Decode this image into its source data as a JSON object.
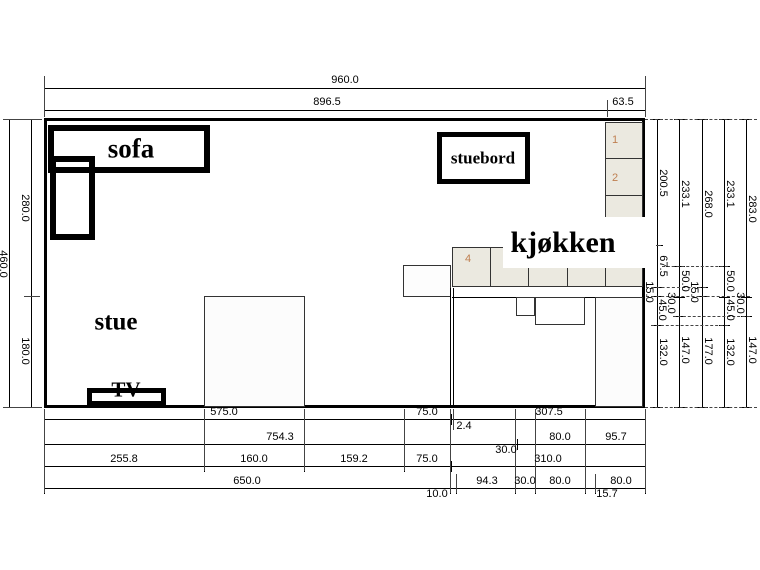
{
  "drawing": {
    "room_labels": {
      "sofa": "sofa",
      "stue": "stue",
      "stuebord": "stuebord",
      "kjokken": "kjøkken",
      "tv": "TV"
    },
    "cabinet_numbers": {
      "c1": "1",
      "c2": "2",
      "c4": "4"
    },
    "colors": {
      "background": "#ffffff",
      "line": "#000000",
      "cabinet_fill": "#ebe9e0",
      "cabinet_number": "#bf7f50"
    },
    "overall": {
      "width_label": "960.0",
      "height_label": "460.0"
    },
    "dimensions": {
      "horizontal": [
        {
          "name": "overall-width",
          "y": 88,
          "ticks": [
            44,
            645
          ],
          "labels": [
            {
              "t": "960.0",
              "cx": 345,
              "cy": 80
            }
          ]
        },
        {
          "name": "width-breakdown",
          "y": 110,
          "ticks": [
            44,
            607,
            645
          ],
          "labels": [
            {
              "t": "896.5",
              "cx": 327,
              "cy": 102
            },
            {
              "t": "63.5",
              "cx": 623,
              "cy": 102
            }
          ]
        },
        {
          "name": "bottom-row-1",
          "y": 419,
          "ticks": [
            44,
            404,
            451,
            453,
            645
          ],
          "labels": [
            {
              "t": "575.0",
              "cx": 224,
              "cy": 412
            },
            {
              "t": "75.0",
              "cx": 427,
              "cy": 412
            },
            {
              "t": "2.4",
              "cx": 464,
              "cy": 426
            },
            {
              "t": "307.5",
              "cx": 549,
              "cy": 412
            }
          ]
        },
        {
          "name": "bottom-row-2",
          "y": 444,
          "ticks": [
            44,
            517,
            535,
            585,
            645
          ],
          "labels": [
            {
              "t": "754.3",
              "cx": 280,
              "cy": 437
            },
            {
              "t": "30.0",
              "cx": 506,
              "cy": 450
            },
            {
              "t": "80.0",
              "cx": 560,
              "cy": 437
            },
            {
              "t": "95.7",
              "cx": 616,
              "cy": 437
            }
          ]
        },
        {
          "name": "bottom-row-3",
          "y": 466,
          "ticks": [
            44,
            204,
            304,
            404,
            451,
            645
          ],
          "labels": [
            {
              "t": "255.8",
              "cx": 124,
              "cy": 459
            },
            {
              "t": "160.0",
              "cx": 254,
              "cy": 459
            },
            {
              "t": "159.2",
              "cx": 354,
              "cy": 459
            },
            {
              "t": "75.0",
              "cx": 427,
              "cy": 459
            },
            {
              "t": "310.0",
              "cx": 548,
              "cy": 459
            }
          ]
        },
        {
          "name": "bottom-row-4",
          "y": 488,
          "ticks": [
            44,
            450,
            456,
            515,
            535,
            585,
            595,
            645
          ],
          "labels": [
            {
              "t": "650.0",
              "cx": 247,
              "cy": 481
            },
            {
              "t": "10.0",
              "cx": 437,
              "cy": 494
            },
            {
              "t": "94.3",
              "cx": 487,
              "cy": 481
            },
            {
              "t": "30.0",
              "cx": 525,
              "cy": 481
            },
            {
              "t": "80.0",
              "cx": 560,
              "cy": 481
            },
            {
              "t": "15.7",
              "cx": 607,
              "cy": 494
            },
            {
              "t": "80.0",
              "cx": 621,
              "cy": 481
            }
          ]
        }
      ],
      "vertical": [
        {
          "name": "overall-height",
          "x": 9,
          "ticks": [
            119,
            407
          ],
          "labels": [
            {
              "t": "460.0",
              "cx": 3,
              "cy": 264
            }
          ]
        },
        {
          "name": "height-breakdown",
          "x": 31,
          "ticks": [
            119,
            296,
            407
          ],
          "labels": [
            {
              "t": "280.0",
              "cx": 25,
              "cy": 208
            },
            {
              "t": "180.0",
              "cx": 25,
              "cy": 351
            }
          ]
        },
        {
          "name": "right-chain-a",
          "x": 657,
          "ticks": [
            119,
            245,
            287,
            296,
            325,
            407
          ],
          "labels": [
            {
              "t": "200.5",
              "cx": 663,
              "cy": 183
            },
            {
              "t": "67.5",
              "cx": 663,
              "cy": 266
            },
            {
              "t": "15.0",
              "cx": 649,
              "cy": 292
            },
            {
              "t": "45.0",
              "cx": 662,
              "cy": 310
            },
            {
              "t": "132.0",
              "cx": 663,
              "cy": 352
            }
          ]
        },
        {
          "name": "right-chain-b",
          "x": 679,
          "ticks": [
            119,
            266,
            297,
            316,
            407
          ],
          "labels": [
            {
              "t": "233.1",
              "cx": 685,
              "cy": 194
            },
            {
              "t": "50.0",
              "cx": 685,
              "cy": 281
            },
            {
              "t": "30.0",
              "cx": 671,
              "cy": 303
            },
            {
              "t": "147.0",
              "cx": 685,
              "cy": 350
            }
          ]
        },
        {
          "name": "right-chain-c",
          "x": 702,
          "ticks": [
            119,
            287,
            296,
            407
          ],
          "labels": [
            {
              "t": "268.0",
              "cx": 708,
              "cy": 204
            },
            {
              "t": "15.0",
              "cx": 694,
              "cy": 292
            },
            {
              "t": "177.0",
              "cx": 708,
              "cy": 351
            }
          ]
        },
        {
          "name": "right-chain-d",
          "x": 724,
          "ticks": [
            119,
            266,
            297,
            325,
            407
          ],
          "labels": [
            {
              "t": "233.1",
              "cx": 730,
              "cy": 194
            },
            {
              "t": "50.0",
              "cx": 730,
              "cy": 281
            },
            {
              "t": "45.0",
              "cx": 730,
              "cy": 310
            },
            {
              "t": "132.0",
              "cx": 730,
              "cy": 352
            }
          ]
        },
        {
          "name": "right-chain-e",
          "x": 746,
          "ticks": [
            119,
            297,
            316,
            407
          ],
          "labels": [
            {
              "t": "283.0",
              "cx": 752,
              "cy": 209
            },
            {
              "t": "30.0",
              "cx": 740,
              "cy": 303
            },
            {
              "t": "147.0",
              "cx": 752,
              "cy": 350
            }
          ]
        }
      ]
    },
    "extension_lines": {
      "v": [
        {
          "x": 44,
          "y1": 76,
          "y2": 117
        },
        {
          "x": 645,
          "y1": 76,
          "y2": 117
        },
        {
          "x": 607,
          "y1": 100,
          "y2": 117
        },
        {
          "x": 44,
          "y1": 409,
          "y2": 493
        },
        {
          "x": 204,
          "y1": 409,
          "y2": 471
        },
        {
          "x": 304,
          "y1": 409,
          "y2": 471
        },
        {
          "x": 404,
          "y1": 409,
          "y2": 471
        },
        {
          "x": 450,
          "y1": 409,
          "y2": 493
        },
        {
          "x": 453,
          "y1": 409,
          "y2": 430
        },
        {
          "x": 456,
          "y1": 474,
          "y2": 493
        },
        {
          "x": 515,
          "y1": 409,
          "y2": 493
        },
        {
          "x": 535,
          "y1": 409,
          "y2": 493
        },
        {
          "x": 585,
          "y1": 409,
          "y2": 493
        },
        {
          "x": 595,
          "y1": 474,
          "y2": 493
        },
        {
          "x": 645,
          "y1": 409,
          "y2": 493
        }
      ],
      "h": [
        {
          "y": 119,
          "x1": 645,
          "x2": 757,
          "dash": true
        },
        {
          "y": 407,
          "x1": 645,
          "x2": 757,
          "dash": true
        },
        {
          "y": 245,
          "x1": 646,
          "x2": 661,
          "dash": false
        },
        {
          "y": 266,
          "x1": 662,
          "x2": 728,
          "dash": true
        },
        {
          "y": 287,
          "x1": 646,
          "x2": 706,
          "dash": true
        },
        {
          "y": 296,
          "x1": 646,
          "x2": 750,
          "dash": true
        },
        {
          "y": 316,
          "x1": 673,
          "x2": 750,
          "dash": true
        },
        {
          "y": 325,
          "x1": 651,
          "x2": 728,
          "dash": true
        },
        {
          "y": 119,
          "x1": 3,
          "x2": 42,
          "dash": false
        },
        {
          "y": 407,
          "x1": 3,
          "x2": 42,
          "dash": false
        },
        {
          "y": 296,
          "x1": 24,
          "x2": 40,
          "dash": false
        }
      ]
    }
  }
}
